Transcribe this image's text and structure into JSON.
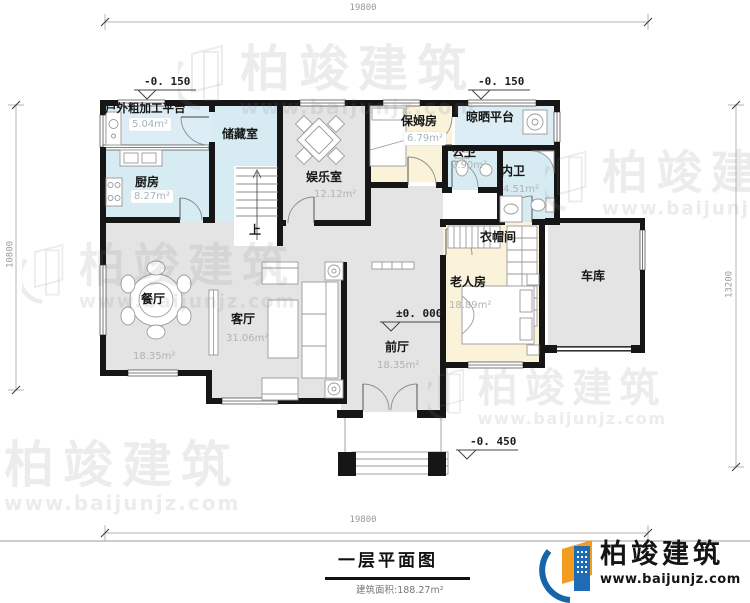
{
  "drawing": {
    "title": "一层平面图",
    "area_note": "建筑面积:188.27m²"
  },
  "brand": {
    "name": "柏竣建筑",
    "website": "www.baijunjz.com"
  },
  "dims": {
    "top": "19800",
    "bottom": "19800",
    "left": "10800",
    "right": "13200"
  },
  "levels": {
    "platform": "-0. 150",
    "drying": "-0. 150",
    "indoor": "±0. 000",
    "entrance": "-0. 450"
  },
  "stairs": {
    "up": "上"
  },
  "rooms": {
    "platform": {
      "name": "户外粗加工平台",
      "area": "5.04m²"
    },
    "kitchen": {
      "name": "厨房",
      "area": "8.27m²"
    },
    "storage": {
      "name": "储藏室"
    },
    "recreation": {
      "name": "娱乐室",
      "area": "12.12m²"
    },
    "nanny": {
      "name": "保姆房",
      "area": "6.79m²"
    },
    "drying": {
      "name": "晾晒平台"
    },
    "public_bath": {
      "name": "公卫",
      "area": "2.90m²"
    },
    "private_bath": {
      "name": "内卫",
      "area": "4.51m²"
    },
    "cloakroom": {
      "name": "衣帽间"
    },
    "elder_room": {
      "name": "老人房",
      "area": "18.89m²"
    },
    "garage": {
      "name": "车库"
    },
    "dining": {
      "name": "餐厅",
      "area": "18.35m²"
    },
    "living": {
      "name": "客厅",
      "area": "31.06m²"
    },
    "foyer": {
      "name": "前厅",
      "area": "18.35m²"
    }
  }
}
